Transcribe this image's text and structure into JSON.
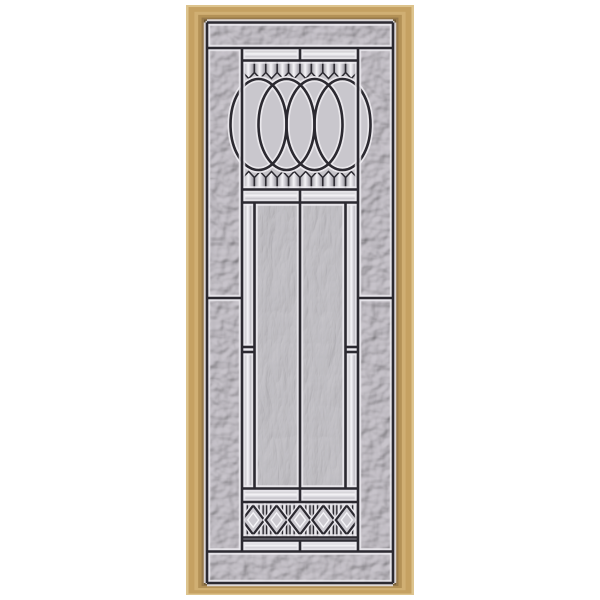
{
  "scene": {
    "background_color": "#ffffff",
    "subject": "decorative-door-glass-insert"
  },
  "frame": {
    "x": 186,
    "y": 5,
    "w": 228,
    "h": 590,
    "thickness": {
      "left": 21,
      "top": 17,
      "right": 21,
      "bottom": 12
    },
    "layers": [
      {
        "t": 0.0,
        "color": "#ddc48e"
      },
      {
        "t": 0.12,
        "color": "#c5a162"
      },
      {
        "t": 0.4,
        "color": "#d0af73"
      },
      {
        "t": 0.58,
        "color": "#b39156"
      },
      {
        "t": 0.74,
        "color": "#97794a"
      },
      {
        "t": 0.86,
        "color": "#6b5634"
      },
      {
        "t": 0.93,
        "color": "#d7d4d6"
      }
    ]
  },
  "glass": {
    "x1": 207,
    "y1": 22,
    "x2": 393,
    "y2": 583,
    "base": "#c9c5cc",
    "swirl_base": "#cac8cd",
    "flat": "#c6c4c9",
    "oval_fill": "#c9c7cd",
    "diamond_fill": "#cccad0"
  },
  "caming": {
    "dark": "#2b2930",
    "halo": "#edebf0",
    "dark_w": 2.6,
    "halo_w": 6.5
  },
  "bevel": {
    "edge": "#9e9ca3",
    "mid": "#f5f4f7",
    "mid2": "#d8d6dc",
    "shade": "#8f8d94"
  },
  "layout": {
    "col_l": 242,
    "col_r": 358,
    "cx": 300,
    "h_top": 48,
    "h_bot": 551.5,
    "side_split": 298,
    "bands": [
      [
        48.5,
        60.5
      ],
      [
        189.5,
        202.5
      ],
      [
        488.5,
        502
      ],
      [
        540.5,
        551.5
      ]
    ],
    "fringe_top": {
      "n": 10,
      "x1": 243,
      "x2": 357,
      "y0": 61,
      "y1": 72.5,
      "tip": 78.5
    },
    "fringe_bot": {
      "n": 10,
      "x1": 243,
      "x2": 357,
      "y0": 189,
      "y1": 177.5,
      "tip": 171.5
    },
    "oval_bg": [
      243,
      61,
      357,
      189
    ],
    "ovals": {
      "cx": [
        258.5,
        286.5,
        314.5,
        342.5
      ],
      "cy": 124.5,
      "rx": 28,
      "ry": 45.5
    },
    "body": {
      "y1": 202.5,
      "y2": 488.5,
      "strip_l": 254.5,
      "strip_r": 345.5,
      "break_ys": [
        347,
        352
      ],
      "panels": [
        [
          256,
          299
        ],
        [
          301,
          344
        ]
      ]
    },
    "dia": {
      "bg": [
        243,
        502,
        357,
        537.5
      ],
      "cy": 520,
      "hw": 11,
      "hh": 14.5,
      "centers": [
        253.2,
        276.6,
        300,
        323.4,
        346.8
      ],
      "bars": [
        245.3,
        261.1,
        268.7,
        284.5,
        292.1,
        307.9,
        315.5,
        331.3,
        338.9,
        354.7
      ],
      "bar_w": 4.2,
      "bar_y1": 503.5,
      "bar_y2": 536
    }
  }
}
